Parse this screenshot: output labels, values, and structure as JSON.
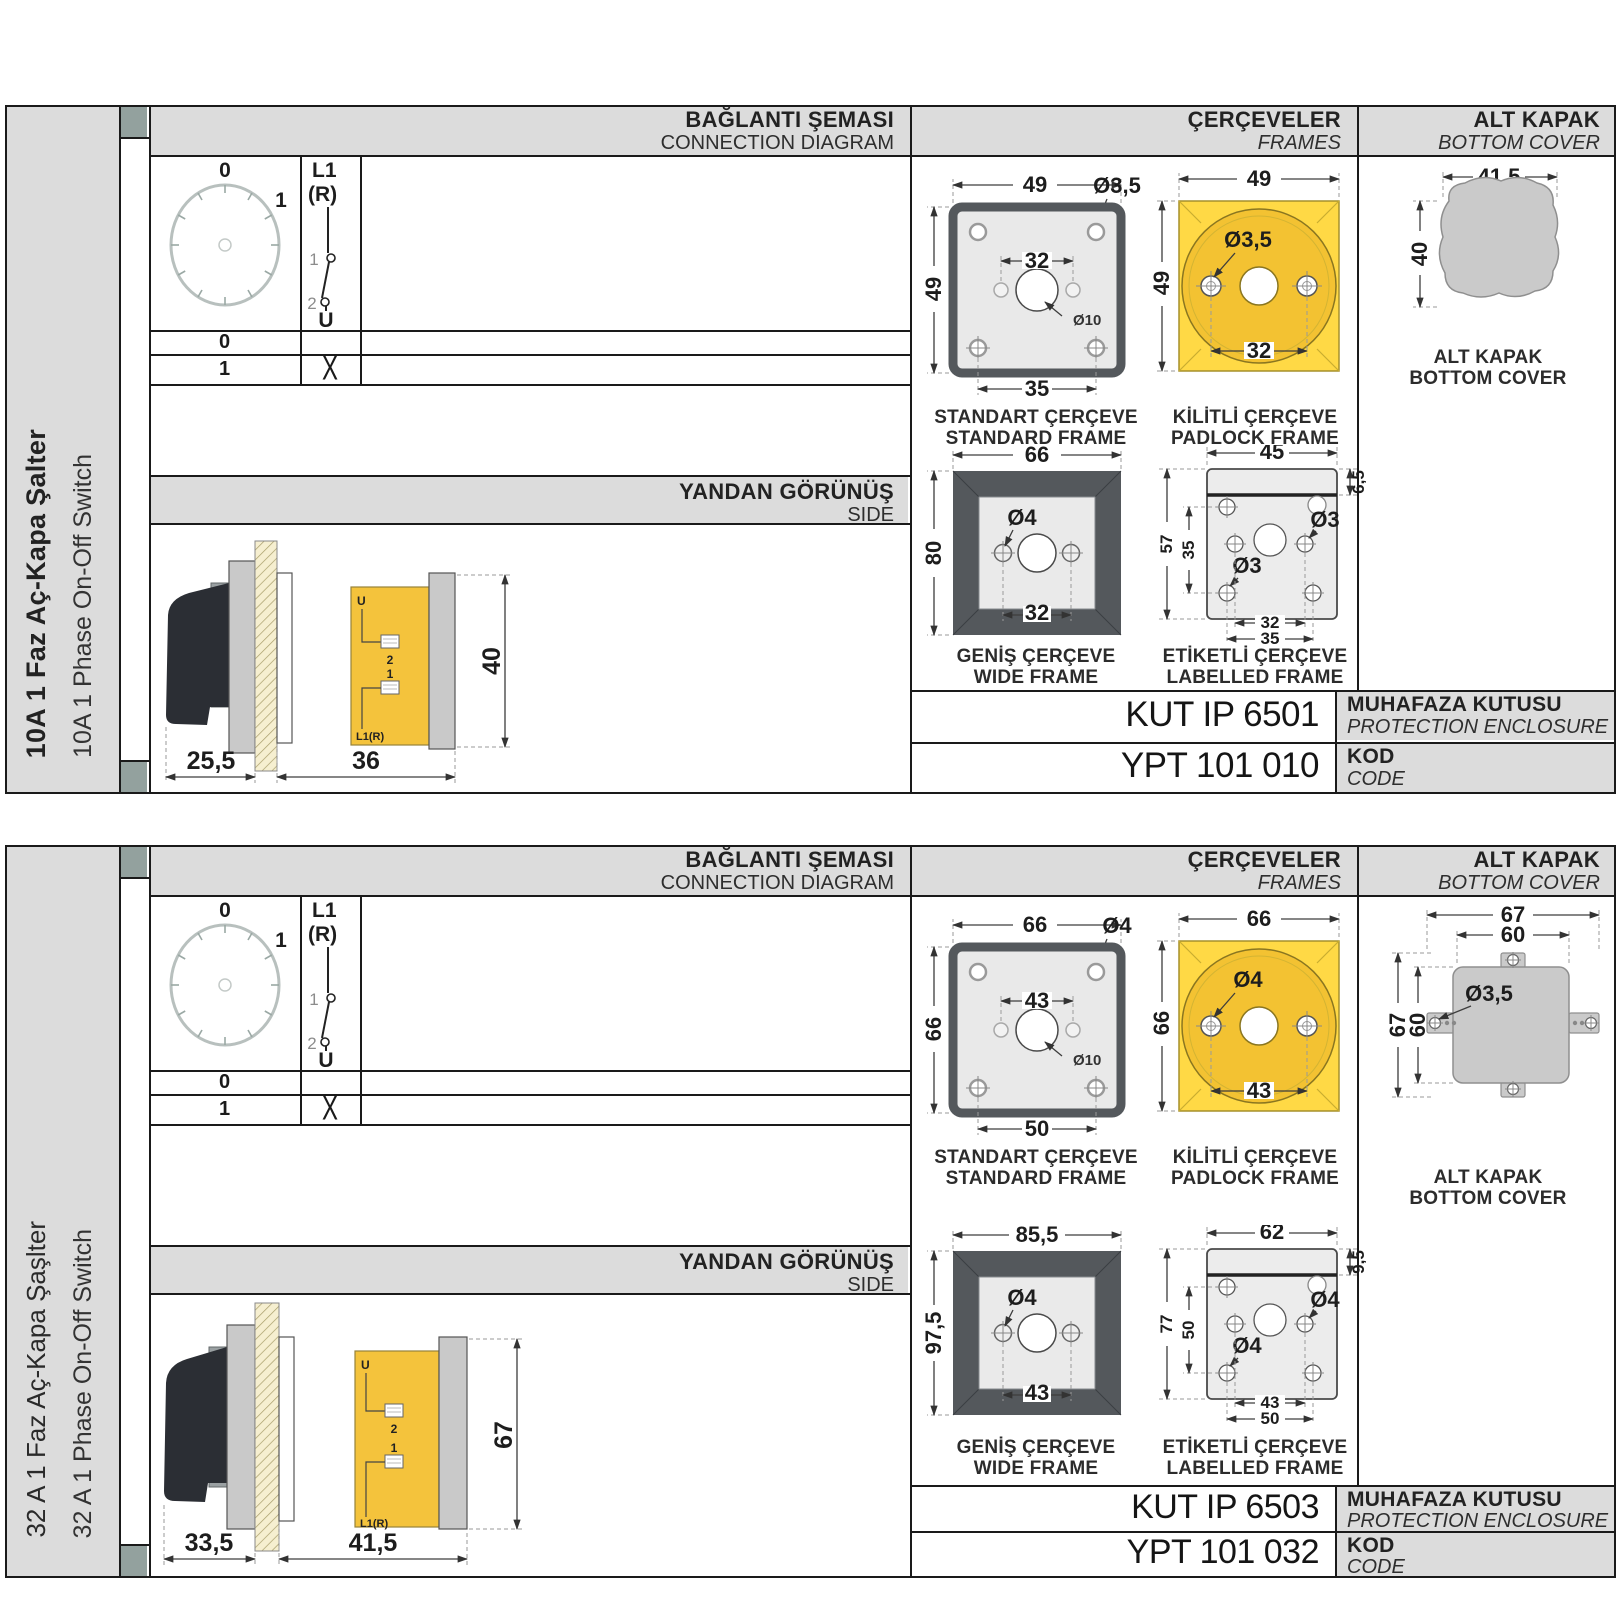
{
  "sections": [
    {
      "sidebar": {
        "title_tr": "10A 1 Faz Aç-Kapa Şalter",
        "title_en": "10A 1 Phase On-Off Switch"
      },
      "connection": {
        "title_tr": "BAĞLANTI ŞEMASI",
        "title_en": "CONNECTION DIAGRAM",
        "dial": {
          "pos_top": "0",
          "pos_right": "1"
        },
        "sw": {
          "line_top": "L1",
          "line_top2": "(R)",
          "contact_1": "1",
          "contact_2": "2",
          "line_bottom": "U"
        },
        "rows": [
          {
            "position": "0",
            "mark": ""
          },
          {
            "position": "1",
            "mark": "X"
          }
        ]
      },
      "side_view": {
        "title_tr": "YANDAN GÖRÜNÜŞ",
        "title_en": "SIDE",
        "labels": {
          "u": "U",
          "t2": "2",
          "t1": "1",
          "l1r": "L1(R)"
        },
        "dims": {
          "depth_front": "25,5",
          "depth_back": "36",
          "height": "40"
        }
      },
      "frames": {
        "title_tr": "ÇERÇEVELER",
        "title_en": "FRAMES",
        "standard": {
          "label_tr": "STANDART ÇERÇEVE",
          "label_en": "STANDARD FRAME",
          "dims": {
            "width": "49",
            "height": "49",
            "hole_span_top": "32",
            "hole_span_bottom": "35",
            "corner_hole": "Ø3,5",
            "center_hole": "Ø10"
          }
        },
        "padlock": {
          "label_tr": "KİLİTLİ ÇERÇEVE",
          "label_en": "PADLOCK FRAME",
          "dims": {
            "width": "49",
            "height": "49",
            "hole": "Ø3,5",
            "hole_span": "32"
          }
        },
        "wide": {
          "label_tr": "GENİŞ ÇERÇEVE",
          "label_en": "WIDE FRAME",
          "dims": {
            "width": "66",
            "height": "80",
            "hole": "Ø4",
            "hole_span": "32"
          }
        },
        "labelled": {
          "label_tr": "ETİKETLİ ÇERÇEVE",
          "label_en": "LABELLED FRAME",
          "dims": {
            "width": "45",
            "label_strip": "6,5",
            "height": "57",
            "hole_height": "35",
            "hole_right": "Ø3",
            "hole_left": "Ø3",
            "span_inner": "32",
            "span_outer": "35"
          }
        }
      },
      "cover": {
        "title_tr": "ALT KAPAK",
        "title_en": "BOTTOM COVER",
        "label_tr": "ALT KAPAK",
        "label_en": "BOTTOM COVER",
        "dims": {
          "width": "41,5",
          "height": "40"
        }
      },
      "codes": {
        "enclosure_value": "KUT IP 6501",
        "enclosure_tr": "MUHAFAZA KUTUSU",
        "enclosure_en": "PROTECTION ENCLOSURE",
        "code_value": "YPT 101 010",
        "code_tr": "KOD",
        "code_en": "CODE"
      }
    },
    {
      "sidebar": {
        "title_tr": "32 A 1 Faz Aç-Kapa Şaşlter",
        "title_en": "32 A 1 Phase On-Off Switch"
      },
      "connection": {
        "title_tr": "BAĞLANTI ŞEMASI",
        "title_en": "CONNECTION DIAGRAM",
        "dial": {
          "pos_top": "0",
          "pos_right": "1"
        },
        "sw": {
          "line_top": "L1",
          "line_top2": "(R)",
          "contact_1": "1",
          "contact_2": "2",
          "line_bottom": "U"
        },
        "rows": [
          {
            "position": "0",
            "mark": ""
          },
          {
            "position": "1",
            "mark": "X"
          }
        ]
      },
      "side_view": {
        "title_tr": "YANDAN GÖRÜNÜŞ",
        "title_en": "SIDE",
        "labels": {
          "u": "U",
          "t2": "2",
          "t1": "1",
          "l1r": "L1(R)"
        },
        "dims": {
          "depth_front": "33,5",
          "depth_back": "41,5",
          "height": "67"
        }
      },
      "frames": {
        "title_tr": "ÇERÇEVELER",
        "title_en": "FRAMES",
        "standard": {
          "label_tr": "STANDART ÇERÇEVE",
          "label_en": "STANDARD FRAME",
          "dims": {
            "width": "66",
            "height": "66",
            "hole_span_top": "43",
            "hole_span_bottom": "50",
            "corner_hole": "Ø4",
            "center_hole": "Ø10"
          }
        },
        "padlock": {
          "label_tr": "KİLİTLİ ÇERÇEVE",
          "label_en": "PADLOCK FRAME",
          "dims": {
            "width": "66",
            "height": "66",
            "hole": "Ø4",
            "hole_span": "43"
          }
        },
        "wide": {
          "label_tr": "GENİŞ ÇERÇEVE",
          "label_en": "WIDE FRAME",
          "dims": {
            "width": "85,5",
            "height": "97,5",
            "hole": "Ø4",
            "hole_span": "43"
          }
        },
        "labelled": {
          "label_tr": "ETİKETLİ ÇERÇEVE",
          "label_en": "LABELLED FRAME",
          "dims": {
            "width": "62",
            "label_strip": "9,5",
            "height": "77",
            "hole_height": "50",
            "hole_right": "Ø4",
            "hole_left": "Ø4",
            "span_inner": "43",
            "span_outer": "50"
          }
        }
      },
      "cover": {
        "title_tr": "ALT KAPAK",
        "title_en": "BOTTOM COVER",
        "label_tr": "ALT KAPAK",
        "label_en": "BOTTOM COVER",
        "dims": {
          "width_outer": "67",
          "width_inner": "60",
          "height_outer": "67",
          "height_inner": "60",
          "hole": "Ø3,5"
        }
      },
      "codes": {
        "enclosure_value": "KUT IP 6503",
        "enclosure_tr": "MUHAFAZA KUTUSU",
        "enclosure_en": "PROTECTION ENCLOSURE",
        "code_value": "YPT 101 032",
        "code_tr": "KOD",
        "code_en": "CODE"
      }
    }
  ]
}
